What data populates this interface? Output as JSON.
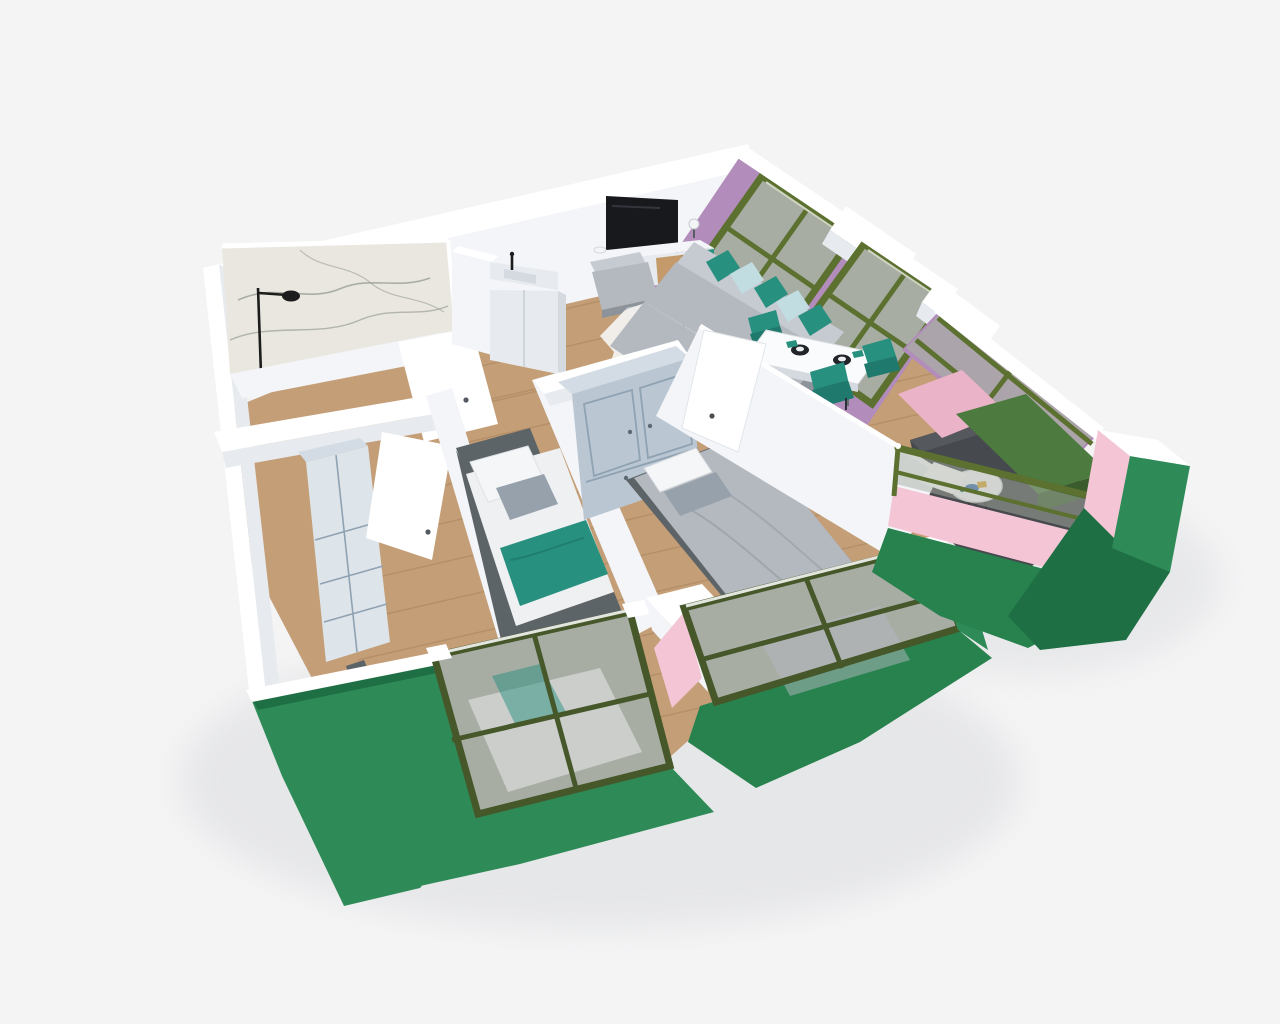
{
  "meta": {
    "description": "3D axonometric dollhouse rendering of a two-bedroom apartment floor plan with balcony",
    "view": "top-down tilted 3D render",
    "visible_text": "none"
  },
  "palette": {
    "bg": "#f4f4f5",
    "shadow": "#dcdddf",
    "wall_cap": "#ffffff",
    "wall_face": "#f3f5f8",
    "wall_face_mid": "#e7ebef",
    "wall_face_dark": "#d4dae0",
    "green": "#2e8b57",
    "green_dark": "#27824e",
    "green_deep": "#1f6f44",
    "olive": "#5c7030",
    "olive_dark": "#46572a",
    "bench_top": "#4d7a3e",
    "bench_front": "#3a5c2d",
    "pink": "#f3c5d5",
    "pink_deep": "#eab3c8",
    "mauve": "#b28cba",
    "glass": "#a8ada4",
    "glass_light": "#b9bdb6",
    "wood": "#c49e77",
    "wood_line": "#a8845c",
    "marble": "#e9e7e0",
    "marble_vein": "#9aa095",
    "balcony_floor": "#46494d",
    "balcony_floor_light": "#55585c",
    "tv": "#17191c",
    "console_wood": "#c49a6b",
    "teal": "#27907f",
    "teal_dark": "#1f7a6d",
    "sofa": "#b4b8bf",
    "sofa_light": "#c6cad1",
    "sofa_dark": "#8d939b",
    "mattress": "#eef0f2",
    "pillow_white": "#f5f6f8",
    "pillow_gray": "#97a1ab",
    "pillow_pattern": "#c2dde1",
    "bed_frame": "#5d6468",
    "wardrobe": "#bac7d3",
    "wardrobe_top": "#d3dce4",
    "wardrobe_seam": "#8fa2b2",
    "wardrobe_gray": "#dde4ea",
    "table_white": "#fafbfc",
    "plate_black": "#212428",
    "rug_white": "#f2f0ec",
    "rug_spot": "#26231f",
    "fixture_black": "#1c1c1c",
    "accent_blue": "#3a6fb0",
    "accent_yellow": "#e2a92e"
  },
  "scene": {
    "rooms": [
      {
        "name": "bathroom",
        "items": [
          "marble-shower-wall",
          "black-shower-fixture",
          "open-door"
        ]
      },
      {
        "name": "kitchen",
        "items": [
          "tall-cabinet",
          "countertop",
          "sink",
          "black-faucet",
          "base-cabinet"
        ]
      },
      {
        "name": "living-room",
        "items": [
          "wall-tv",
          "media-console",
          "table-lamp",
          "armchair",
          "armchair",
          "round-coffee-table",
          "cowhide-rug",
          "corner-sofa",
          "teal-pillows",
          "patterned-pillows"
        ]
      },
      {
        "name": "dining-area",
        "items": [
          "marble-dining-table",
          "place-settings",
          "teal-dining-chairs"
        ]
      },
      {
        "name": "bedroom-1",
        "items": [
          "single-bed",
          "teal-throw",
          "tall-wardrobe",
          "cowhide-rug",
          "open-door",
          "window"
        ]
      },
      {
        "name": "bedroom-2",
        "items": [
          "single-bed",
          "teal-throw",
          "gray-accent-pillow"
        ]
      },
      {
        "name": "master-bedroom",
        "items": [
          "double-bed",
          "blue-gray-wardrobe",
          "open-door",
          "window"
        ]
      },
      {
        "name": "balcony",
        "items": [
          "green-bench",
          "white-bistro-table",
          "olive-railing",
          "glass-parapet"
        ]
      }
    ],
    "exterior": [
      "green-facade",
      "pink-facade",
      "mauve-facade",
      "olive-window-frames",
      "white-wall-caps"
    ]
  }
}
